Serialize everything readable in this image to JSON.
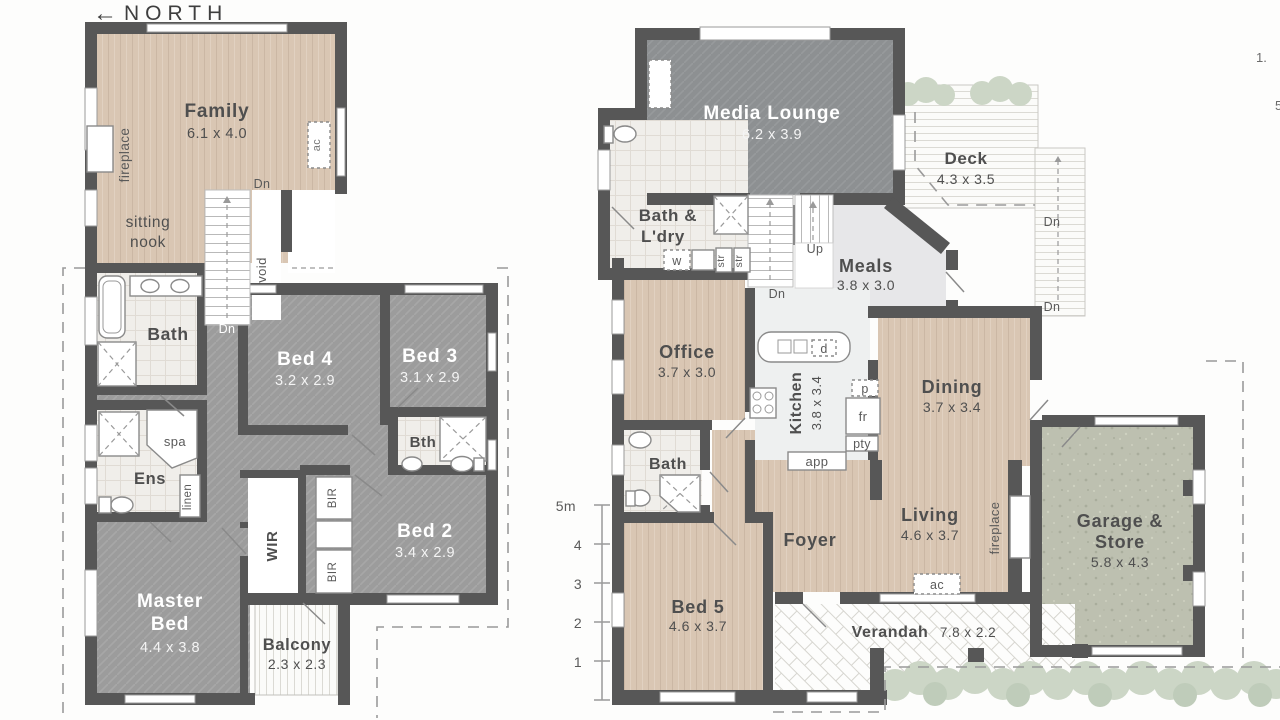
{
  "meta": {
    "north_arrow": "←",
    "north_label": "NORTH"
  },
  "palette": {
    "wall": "#575757",
    "wood_floor": "#d9c6b3",
    "carpet": "#9c9c9c",
    "media_carpet": "#8d9092",
    "tile": "#f0eeea",
    "garage_floor": "#bdc0b0",
    "greenery": "#ccd6c6",
    "text_dark": "#4f4f4f",
    "text_white": "#ffffff",
    "dashed_line": "#9a9a9a"
  },
  "upper_floor": {
    "family": {
      "name": "Family",
      "dims": "6.1 x 4.0"
    },
    "fireplace": "fireplace",
    "sitting_nook_line1": "sitting",
    "sitting_nook_line2": "nook",
    "stairs_dn_top": "Dn",
    "stairs_dn_bottom": "Dn",
    "void": "void",
    "bath": "Bath",
    "bed4": {
      "name": "Bed 4",
      "dims": "3.2 x 2.9"
    },
    "bed3": {
      "name": "Bed 3",
      "dims": "3.1 x 2.9"
    },
    "spa": "spa",
    "ens": "Ens",
    "linen": "linen",
    "bth": "Bth",
    "wir": "WIR",
    "bir_top": "BIR",
    "bir_bottom": "BIR",
    "bed2": {
      "name": "Bed 2",
      "dims": "3.4 x 2.9"
    },
    "master": {
      "line1": "Master",
      "line2": "Bed",
      "dims": "4.4 x 3.8"
    },
    "balcony": {
      "name": "Balcony",
      "dims": "2.3 x 2.3"
    },
    "ac": "ac"
  },
  "ground_floor": {
    "media": {
      "name": "Media Lounge",
      "dims": "6.2 x 3.9"
    },
    "ac_media": "ac",
    "deck": {
      "name": "Deck",
      "dims": "4.3 x 3.5"
    },
    "deck_dn_upper": "Dn",
    "deck_dn_lower": "Dn",
    "bath_ldry": {
      "line1": "Bath &",
      "line2": "L'dry"
    },
    "washer": "w",
    "store1": "str",
    "store2": "str",
    "stairs_up": "Up",
    "stairs_dn": "Dn",
    "meals": {
      "name": "Meals",
      "dims": "3.8 x 3.0"
    },
    "office": {
      "name": "Office",
      "dims": "3.7 x 3.0"
    },
    "kitchen": {
      "name": "Kitchen",
      "dims": "3.8 x 3.4"
    },
    "dishwasher": "d",
    "pantry_p": "p",
    "fridge": "fr",
    "pantry": "pty",
    "appliances": "app",
    "dining": {
      "name": "Dining",
      "dims": "3.7 x 3.4"
    },
    "bath": "Bath",
    "foyer": "Foyer",
    "living": {
      "name": "Living",
      "dims": "4.6 x 3.7"
    },
    "fireplace": "fireplace",
    "ac_living": "ac",
    "garage": {
      "line1": "Garage &",
      "line2": "Store",
      "dims": "5.8 x 4.3"
    },
    "bed5": {
      "name": "Bed 5",
      "dims": "4.6 x 3.7"
    },
    "verandah": {
      "name": "Verandah",
      "dims": "7.8 x 2.2"
    }
  },
  "scale_bar": {
    "label_5m": "5m",
    "tick_4": "4",
    "tick_3": "3",
    "tick_2": "2",
    "tick_1": "1"
  },
  "margin_notes": {
    "note_1": "1.",
    "note_2": "5"
  }
}
